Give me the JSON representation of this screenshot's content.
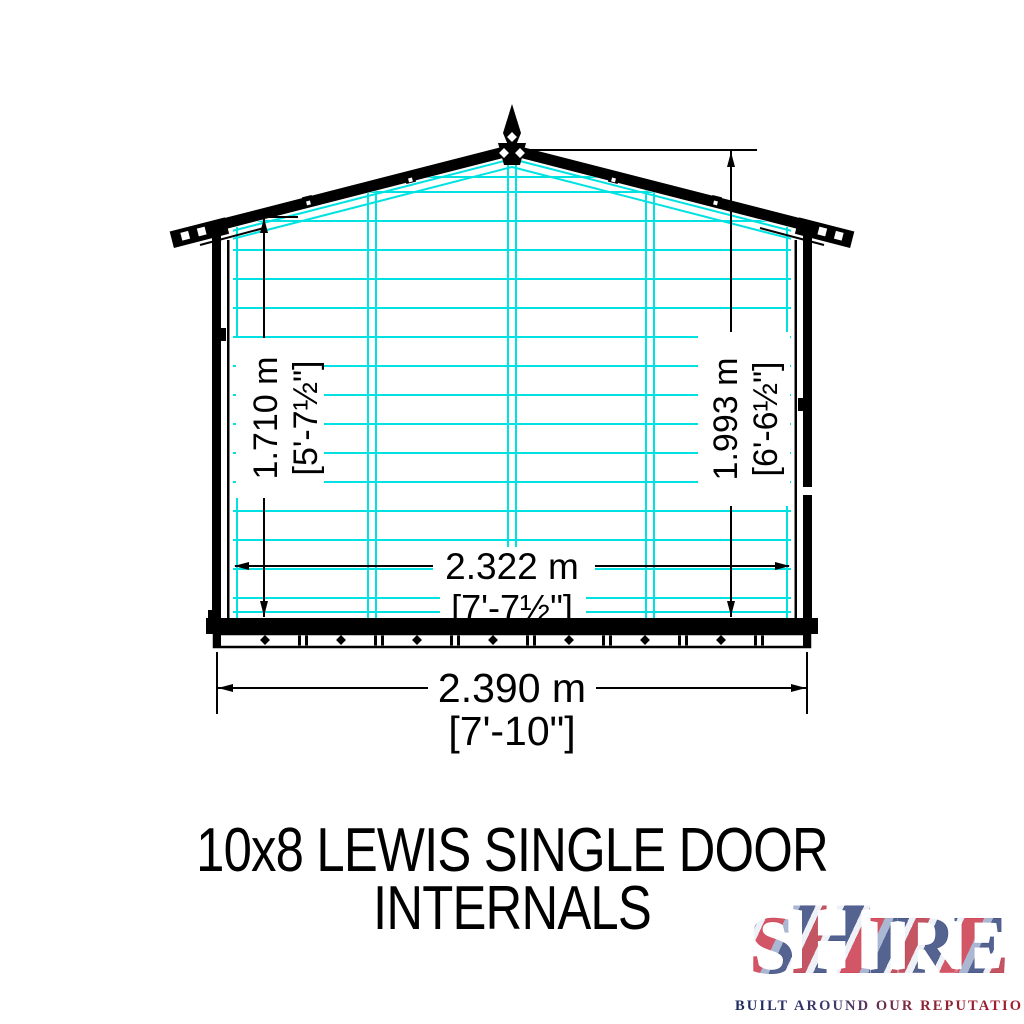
{
  "drawing": {
    "dim_height_eaves_m": "1.710 m",
    "dim_height_eaves_imperial": "[5'-7½\"]",
    "dim_height_ridge_m": "1.993 m",
    "dim_height_ridge_imperial": "[6'-6½\"]",
    "dim_width_internal_m": "2.322 m",
    "dim_width_internal_imperial": "[7'-7½\"]",
    "dim_width_external_m": "2.390 m",
    "dim_width_external_imperial": "[7'-10\"]"
  },
  "title": {
    "line1": "10x8 LEWIS SINGLE DOOR",
    "line2": "INTERNALS"
  },
  "logo": {
    "letters": [
      "S",
      "H",
      "I",
      "R",
      "E"
    ],
    "tagline": "BUILT AROUND OUR REPUTATION"
  },
  "colors": {
    "framing_cyan": "#00E2E2",
    "ink_black": "#000000",
    "logo_red": "#C8102E",
    "logo_blue": "#1D2F6D"
  }
}
